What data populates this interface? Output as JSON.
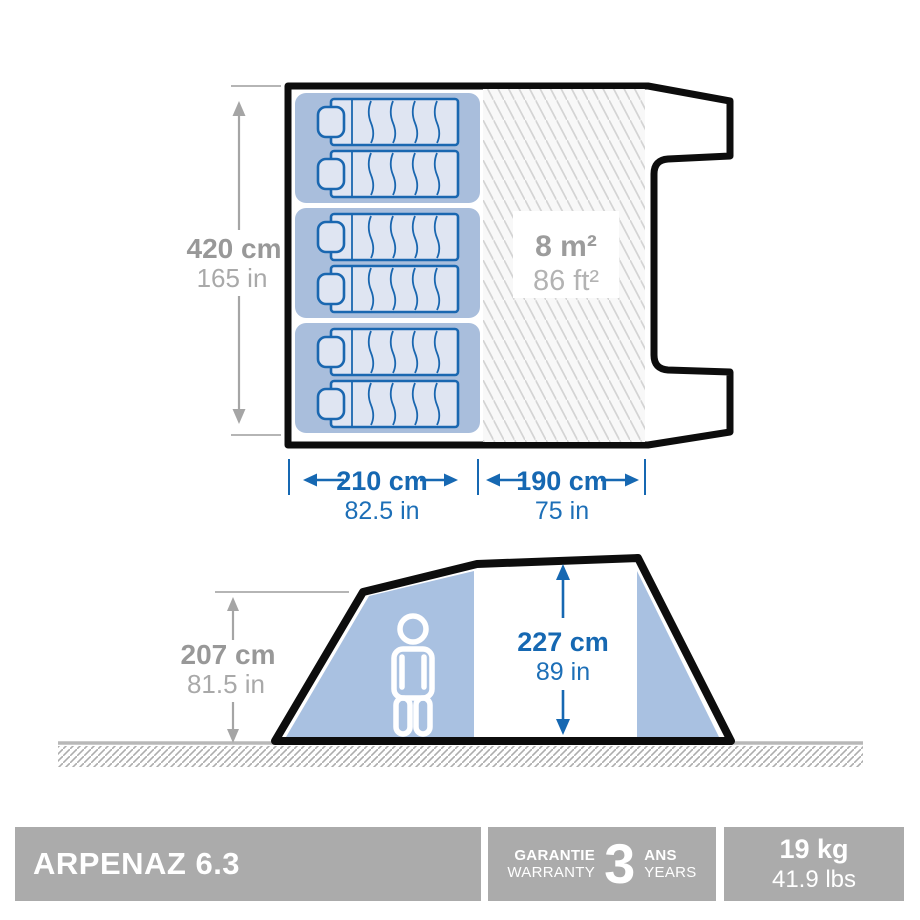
{
  "top_view": {
    "depth_cm": "420 cm",
    "depth_in": "165 in",
    "bedroom_width_cm": "210 cm",
    "bedroom_width_in": "82.5 in",
    "living_width_cm": "190 cm",
    "living_width_in": "75 in",
    "living_area_m2": "8 m²",
    "living_area_ft2": "86 ft²"
  },
  "side_view": {
    "peak_height_cm": "207 cm",
    "peak_height_in": "81.5 in",
    "interior_height_cm": "227 cm",
    "interior_height_in": "89 in"
  },
  "footer": {
    "product_name": "ARPENAZ 6.3",
    "warranty_label_fr": "GARANTIE",
    "warranty_label_en": "WARRANTY",
    "warranty_years": "3",
    "warranty_unit_fr": "ANS",
    "warranty_unit_en": "YEARS",
    "weight_metric": "19 kg",
    "weight_imperial": "41.9 lbs"
  },
  "colors": {
    "dimension_blue": "#1668b2",
    "dimension_gray": "#a5a5a5",
    "room_fill": "#a9bedc",
    "mattress_fill": "#dfe5f2",
    "mattress_stroke": "#1a67b0",
    "side_panel_fill": "#a9c1e1",
    "outline_black": "#0d0d0d",
    "footer_gray": "#ababab"
  }
}
